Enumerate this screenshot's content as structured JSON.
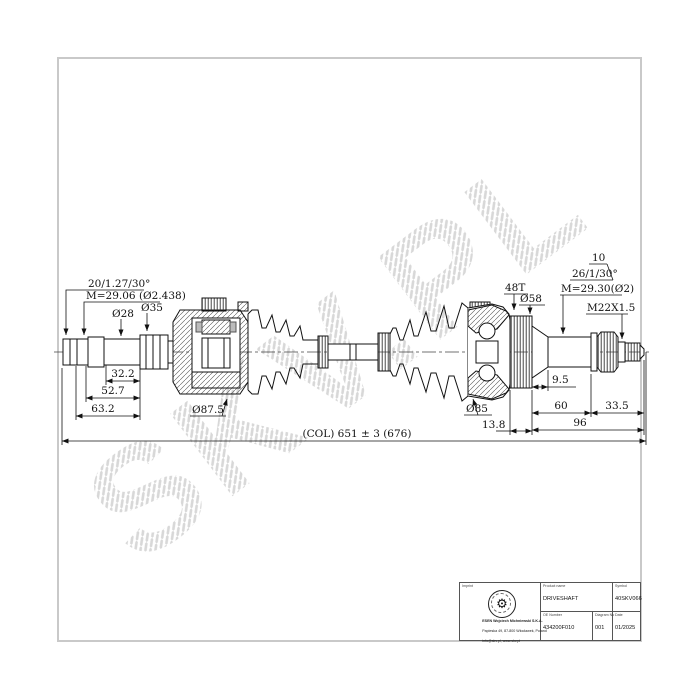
{
  "watermark": "SKV.PL",
  "icons": {
    "gear": "⚙"
  },
  "labels": {
    "spline_left": "20/1.27/30°",
    "pins_left": "M=29.06 (Ø2.438)",
    "dia28": "Ø28",
    "dia35": "Ø35",
    "len32": "32.2",
    "len52": "52.7",
    "len63": "63.2",
    "dia87": "Ø87.5",
    "overall": "(COL) 651 ± 3 (676)",
    "len13": "13.8",
    "dia85": "Ø85",
    "len9": "9.5",
    "len60": "60",
    "len33": "33.5",
    "len96": "96",
    "teeth48": "48T",
    "dia58": "Ø58",
    "note10": "10",
    "spline_right": "26/1/30°",
    "pins_right": "M=29.30(Ø2)",
    "thread": "M22X1.5"
  },
  "title_block": {
    "imprint_label": "Imprint",
    "product_name_label": "Product name",
    "product_name": "DRIVESHAFT",
    "symbol_label": "Symbol",
    "symbol": "40SKV066",
    "oe_number_label": "OE Number",
    "oe_number": "434200F010",
    "diagram_no_label": "Diagram No",
    "diagram_no": "001",
    "date_label": "Date",
    "date": "01/2025",
    "company_line1": "ESEN Wojciech Michniewski S.K.A.",
    "company_line2": "Papieska 49, 87-800 Włocławek, Poland",
    "company_line3": "info@skv.pl, www.skv.pl"
  },
  "colors": {
    "line": "#1a1a1a",
    "frame": "#c9c9c9",
    "watermark": "#dcdcdc"
  }
}
